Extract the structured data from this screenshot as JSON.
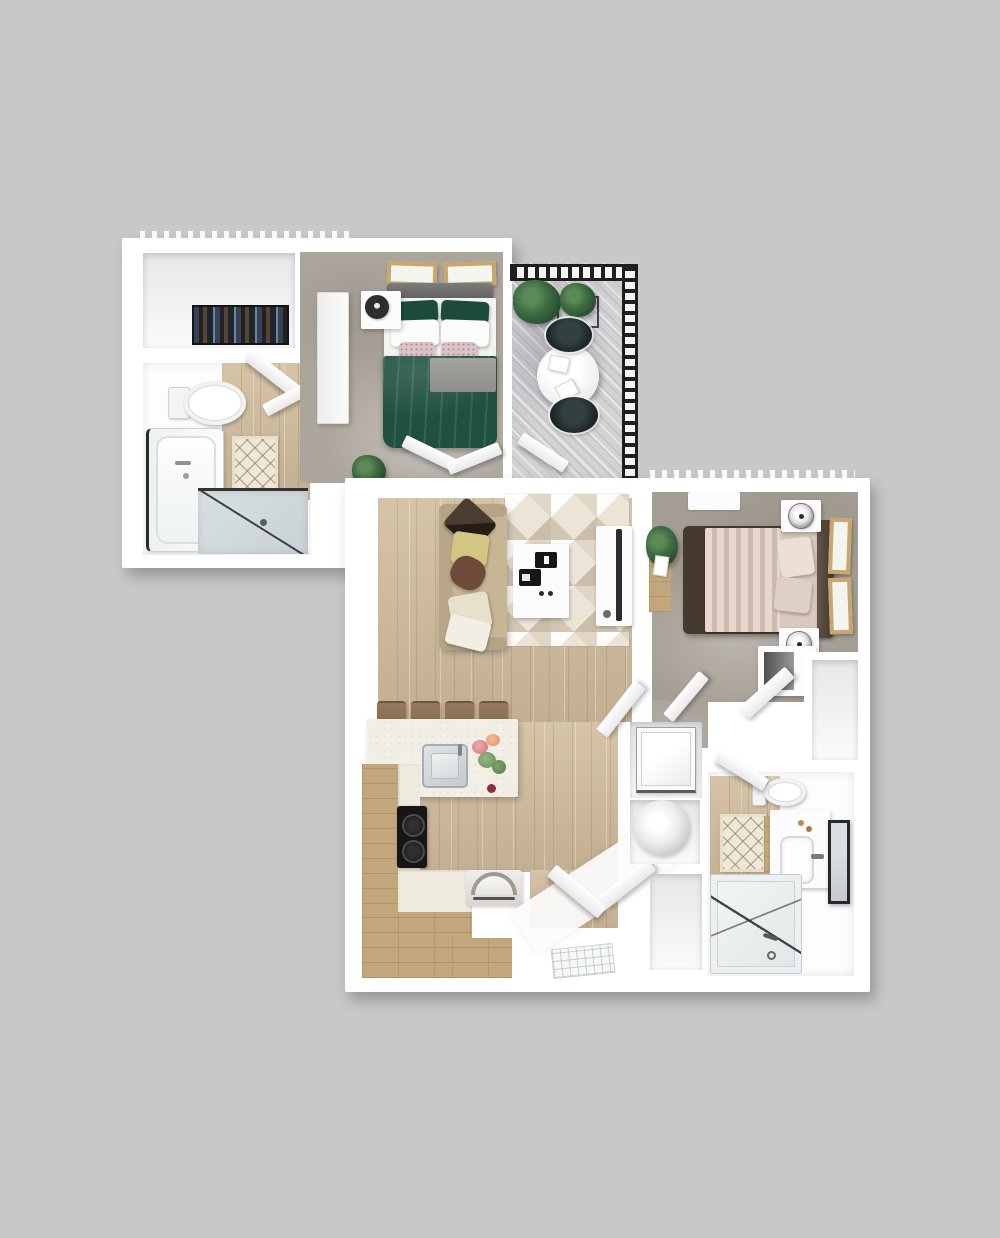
{
  "palette": {
    "background": "#c8c8c8",
    "unit-white": "#ffffff",
    "wood-floor-light": "#d1bc9c",
    "wood-cabinet": "#c2a77d",
    "carpet-a": "#aca59c",
    "carpet-b": "#a49d93",
    "rug-base": "#ece4d6",
    "rug-triangle": "#d3c7b2",
    "sofa-beige": "#c7b694",
    "bed-green": "#20503f",
    "bed-blush": "#d9c9bf",
    "bed-frame-brown": "#463930",
    "headboard-gray": "#6e6e6e",
    "balcony-floor": "#d2d2d5",
    "railing-black": "#1e1e1e",
    "glass-blue": "#d9e0e3",
    "mat-cream": "#efe8d9",
    "mat-lattice": "#8c7850",
    "plant-green": "#3c6a40",
    "appliance-black": "#161616",
    "frame-tan": "#c7a76e",
    "stool-brown": "#8a6f52",
    "steel-gray": "#c4cacd"
  },
  "scene": {
    "view": "top-down 3D render of two overlapping apartment floor plans on a gray background",
    "units": [
      {
        "id": "unit-a",
        "label": "studio unit (upper left)",
        "rooms": [
          {
            "name": "walk-in-closet",
            "items": [
              "clothes-rack"
            ]
          },
          {
            "name": "bathroom",
            "items": [
              "toilet",
              "bathtub",
              "bath-mat",
              "glass-shower",
              "swing-door"
            ]
          },
          {
            "name": "bedroom",
            "items": [
              "picture-frame",
              "picture-frame",
              "bed-with-green-duvet",
              "green-pillows",
              "white-pillows",
              "accent-pillows",
              "gray-blanket",
              "nightstand",
              "table-fan",
              "wardrobe-cabinet",
              "potted-plant",
              "swing-door",
              "entry-door"
            ]
          }
        ]
      },
      {
        "id": "balcony",
        "label": "balcony (top right)",
        "items": [
          "railing-top",
          "railing-right",
          "potted-plant",
          "potted-plant",
          "planter-box",
          "bistro-table",
          "napkins",
          "cafe-chair",
          "cafe-chair",
          "balcony-door"
        ]
      },
      {
        "id": "unit-b",
        "label": "one-bedroom unit (lower right)",
        "rooms": [
          {
            "name": "living-room",
            "items": [
              "sofa",
              "throw-pillows",
              "geometric-area-rug",
              "coffee-table",
              "tablet",
              "book",
              "coasters",
              "tv-console",
              "tv"
            ]
          },
          {
            "name": "kitchen",
            "items": [
              "island-counter",
              "stainless-sink",
              "flower-bouquet",
              "bar-stool",
              "bar-stool",
              "bar-stool",
              "bar-stool",
              "cooktop",
              "range-oven",
              "wood-cabinets"
            ]
          },
          {
            "name": "entry",
            "items": [
              "entry-door",
              "closet-door",
              "door-mat"
            ]
          },
          {
            "name": "laundry-closet",
            "items": [
              "washer",
              "dryer"
            ]
          },
          {
            "name": "linen-closet",
            "items": []
          },
          {
            "name": "bedroom",
            "items": [
              "window",
              "bed-with-blush-duvet",
              "pillows",
              "headboard",
              "nightstand",
              "table-lamp",
              "nightstand",
              "table-lamp",
              "picture-frame",
              "picture-frame",
              "console-table",
              "potted-plant",
              "built-in-closet",
              "swing-door",
              "swing-door"
            ]
          },
          {
            "name": "walk-in-closet",
            "items": []
          },
          {
            "name": "bathroom",
            "items": [
              "toilet",
              "wood-vanity",
              "sink",
              "mirror",
              "bath-mat",
              "tub-shower",
              "swing-door"
            ]
          }
        ]
      }
    ]
  }
}
